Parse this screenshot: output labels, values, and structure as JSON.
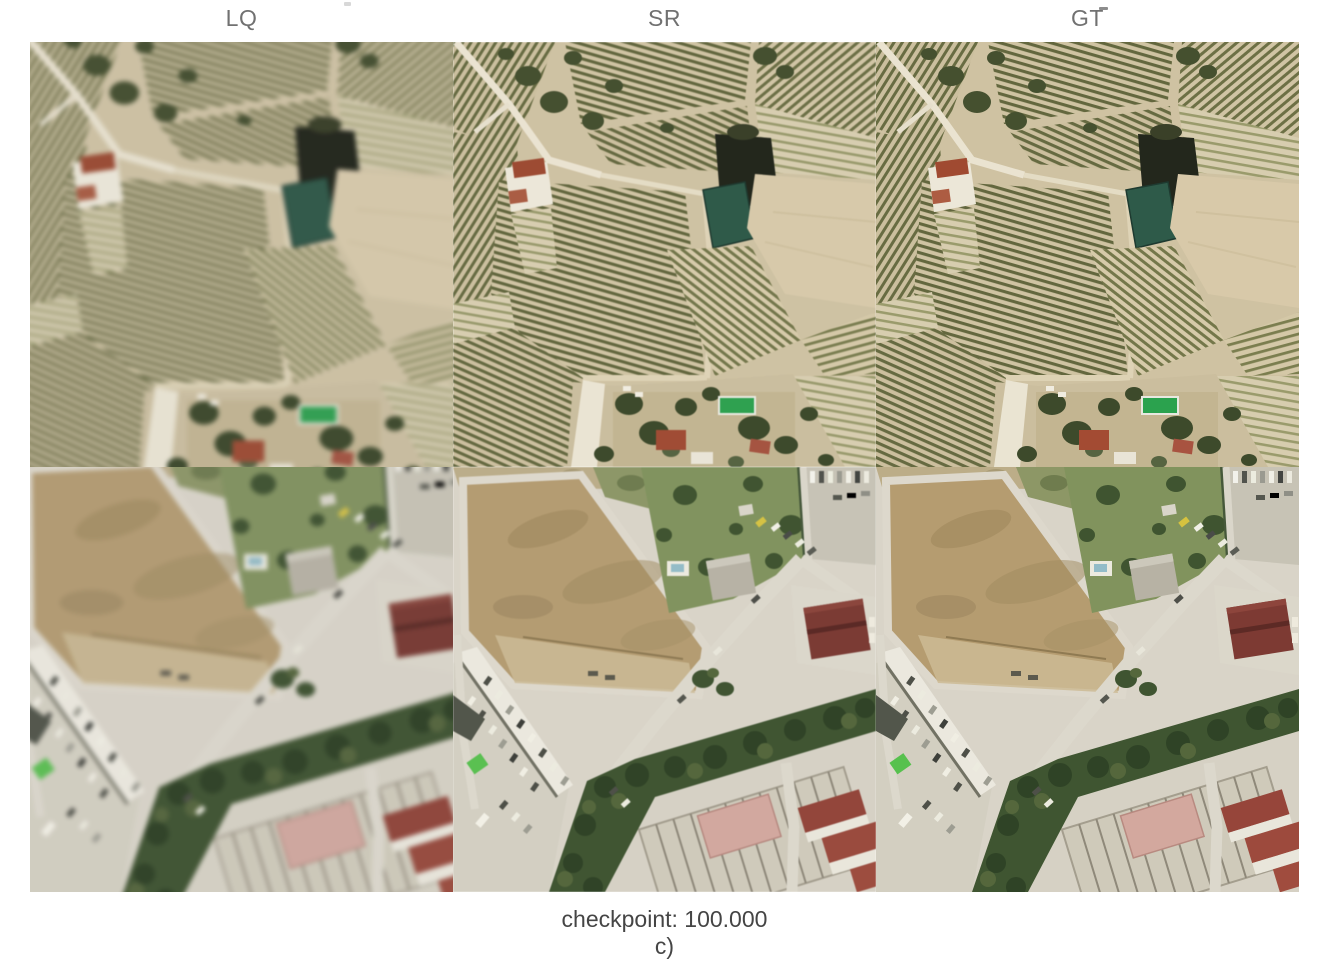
{
  "header": {
    "columns": [
      {
        "id": "lq",
        "label": "LQ"
      },
      {
        "id": "sr",
        "label": "SR"
      },
      {
        "id": "gt",
        "label": "GT"
      }
    ]
  },
  "grid": {
    "rows": [
      {
        "id": "row1",
        "description": "Aerial orthophoto of vineyard parcels with dark irrigation pond, teal reservoir, bare tan field, farmhouse with red roof and garden with green pool"
      },
      {
        "id": "row2",
        "description": "Aerial orthophoto of suburban outskirts with large brown dirt lot, diagonal road, dense tree line, parking lots with cars, maroon-roofed building and warehouse blocks"
      }
    ]
  },
  "caption": {
    "line1": "checkpoint: 100.000",
    "line2": "c)"
  },
  "palette": {
    "background": "#ffffff",
    "label_gray": "#717171",
    "caption_gray": "#454545",
    "soil_tan": "#cfc2a2",
    "vine_row_olive": "#63673e",
    "tree_dark_green": "#3f5431",
    "pond_dark": "#23271c",
    "pond_teal": "#2e5a49",
    "pool_green": "#2ba24e",
    "bare_field": "#d8c9a9",
    "red_roof": "#a34b33",
    "dirt_field": "#b59c70",
    "road_light": "#dcd8cc",
    "lawn_green": "#81935d",
    "maroon_roof": "#7d3a33",
    "apartment_red": "#9a483c",
    "court_pink": "#d3a89e",
    "bright_green_object": "#57c14e"
  }
}
